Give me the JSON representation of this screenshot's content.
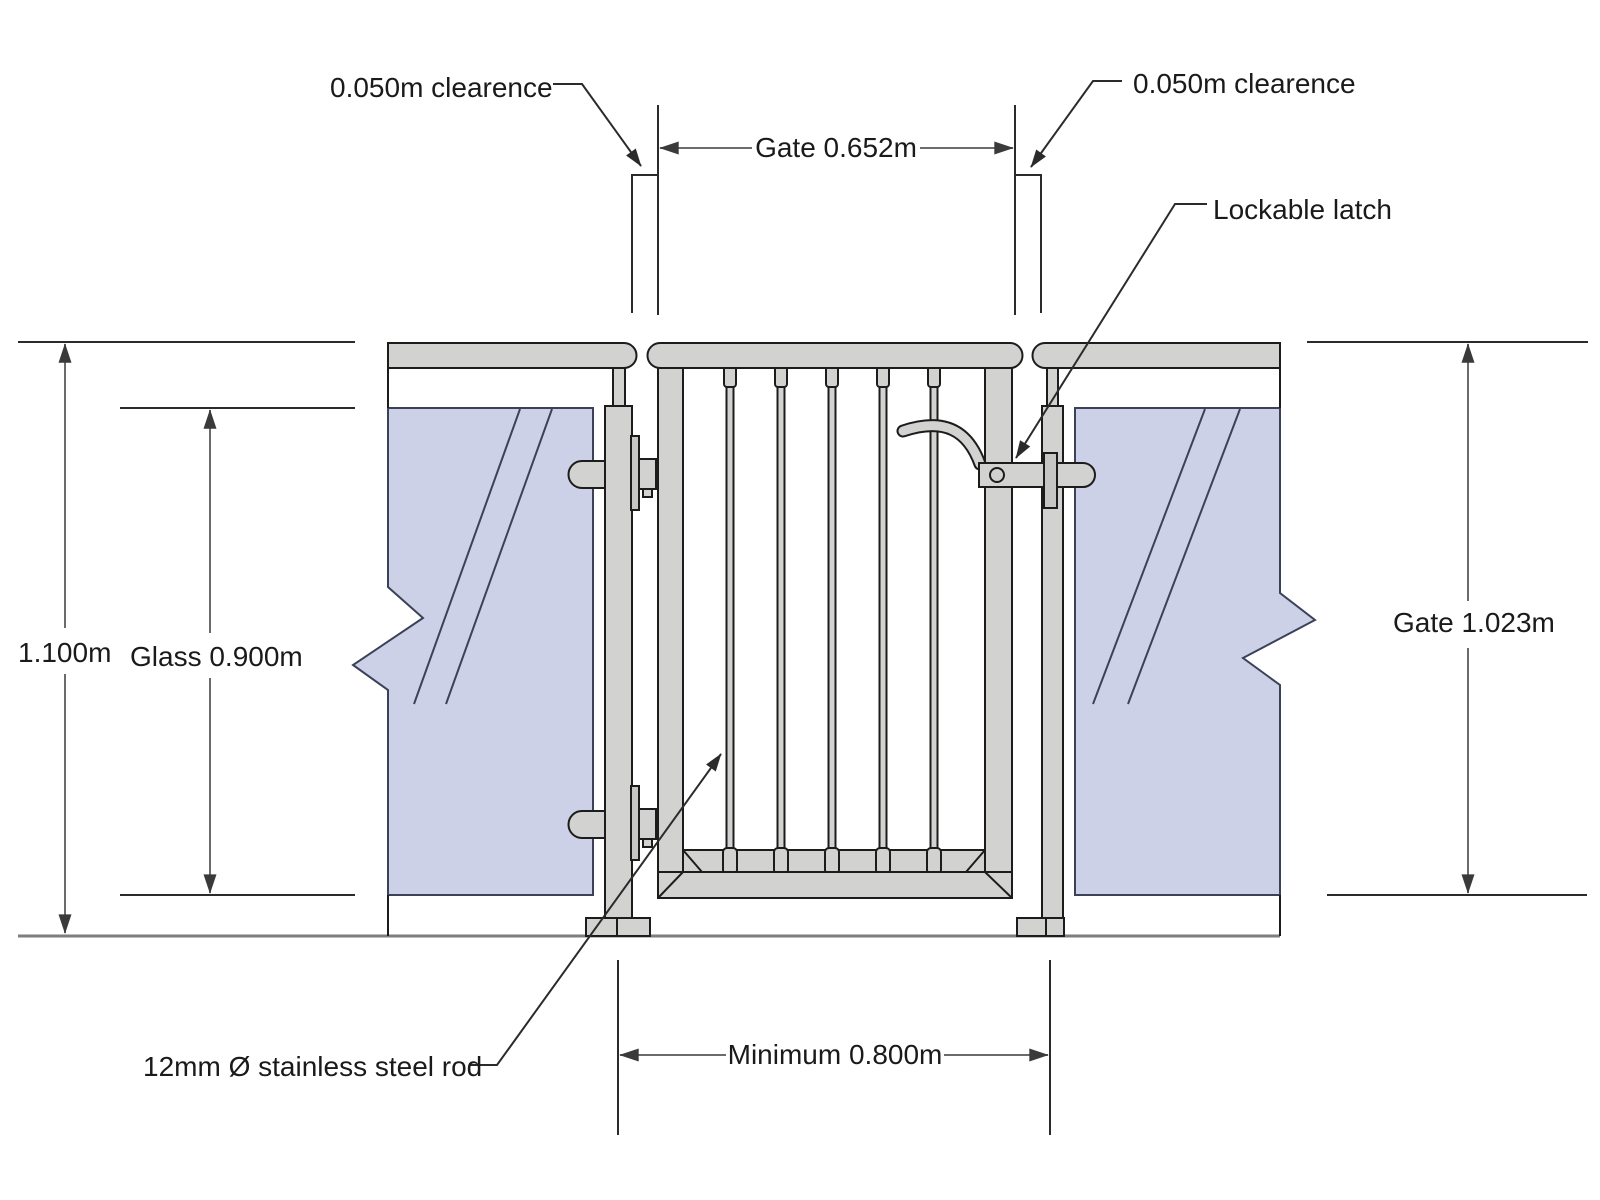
{
  "drawing": {
    "labels": {
      "clearance_left": "0.050m clearence",
      "clearance_right": "0.050m clearence",
      "gate_width": "Gate 0.652m",
      "lockable_latch": "Lockable latch",
      "overall_height": "1.100m",
      "glass_height": "Glass 0.900m",
      "gate_height": "Gate 1.023m",
      "rod_note": "12mm Ø stainless steel rod",
      "min_opening": "Minimum 0.800m"
    },
    "colors": {
      "metal": "#d2d2d0",
      "metal_dark": "#c6c6c4",
      "glass": "#cdd1e8",
      "glass_outline": "#3b4158",
      "outline": "#1c1c1c",
      "dimension_line": "#6b6b6b",
      "arrow": "#3a3a3a",
      "text": "#1a1a1a"
    }
  }
}
